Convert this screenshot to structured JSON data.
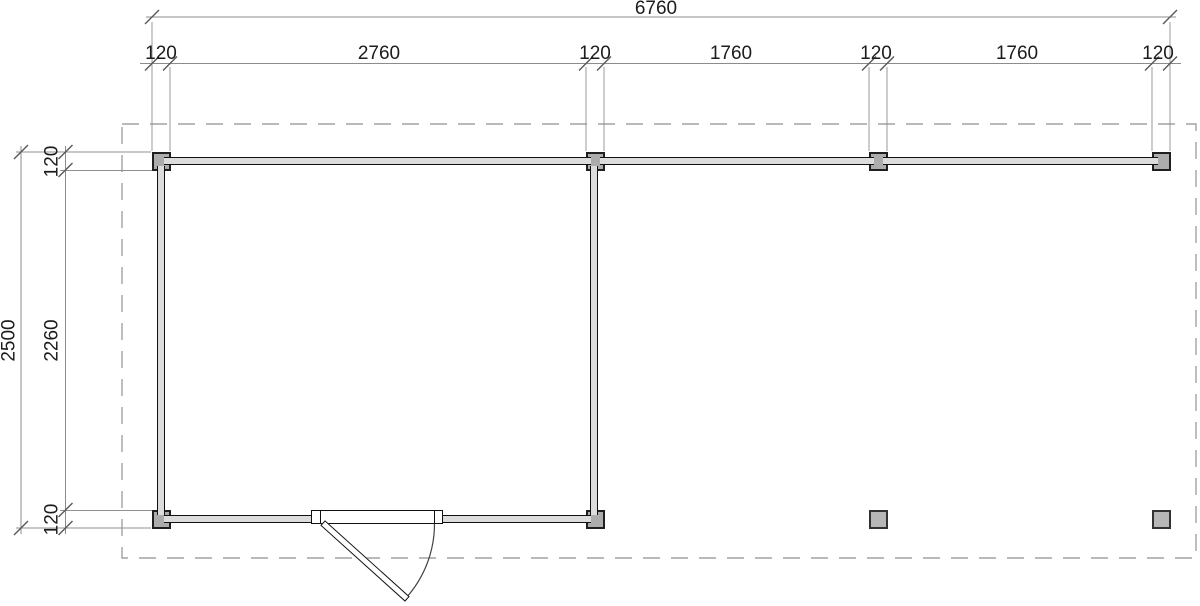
{
  "drawing": {
    "kind": "floor-plan",
    "posts_count": 8,
    "has_door": true
  },
  "dimensions": {
    "overall_width": "6760",
    "overall_depth": "2500",
    "top_segments": [
      "120",
      "2760",
      "120",
      "1760",
      "120",
      "1760",
      "120"
    ],
    "left_segments": [
      "120",
      "2260",
      "120"
    ]
  },
  "colors": {
    "background": "#ffffff",
    "wall_line": "#111111",
    "wall_fill": "#dcdcdc",
    "post_fill": "#acacac",
    "dimension_line": "#8c8c8c",
    "overhang_dash": "#a2a2a2"
  }
}
